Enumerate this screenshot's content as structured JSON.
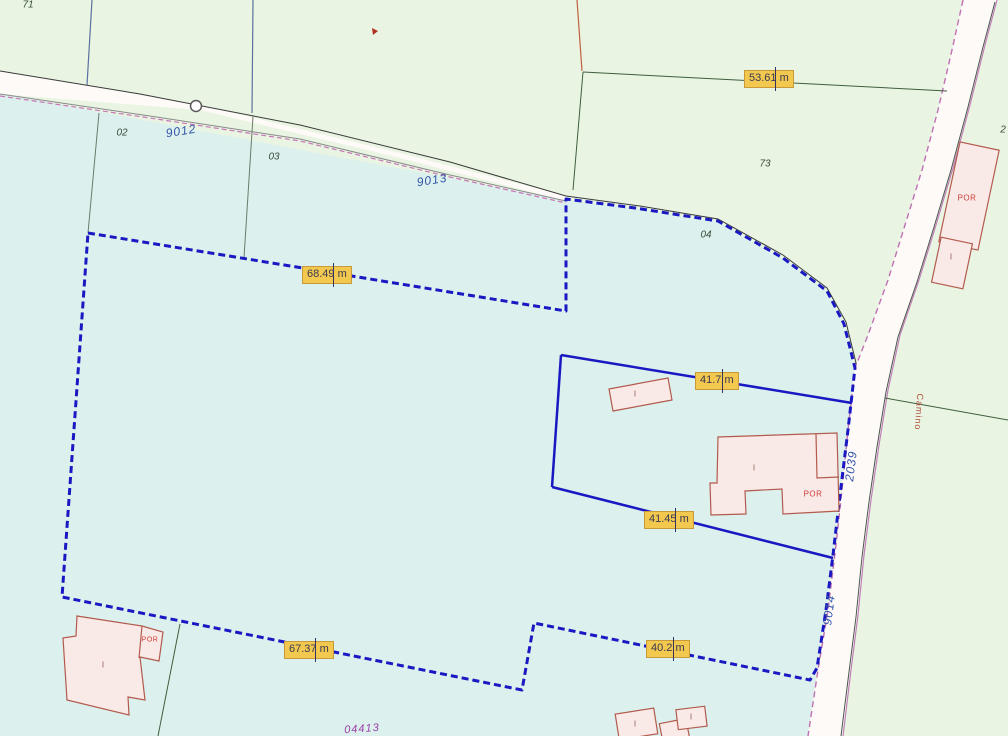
{
  "map": {
    "colors": {
      "background_green": "#E9F5E2",
      "selected_parcel_fill": "#DCF1ED",
      "road_fill": "#FDFAF8",
      "boundary_blue": "#1A18C2",
      "road_edge_pink": "#C070B4",
      "measure_label_bg": "#F2C84F",
      "measure_label_border": "#C89A3A",
      "building_fill": "#FAEAE7",
      "building_border": "#B25A4E"
    },
    "measurement_labels": [
      {
        "text": "53.61 m"
      },
      {
        "text": "52.91 m"
      },
      {
        "text": "46.83 m"
      },
      {
        "text": "68.49 m"
      },
      {
        "text": "41.7 m"
      },
      {
        "text": "52.01 m"
      },
      {
        "text": "20.19 m"
      },
      {
        "text": "41.45 m"
      },
      {
        "text": "17.02 m"
      },
      {
        "text": "67.37 m"
      },
      {
        "text": "9.64 m"
      },
      {
        "text": "40.2 m"
      }
    ],
    "road_labels": {
      "road_9012": "9012",
      "road_9013": "9013",
      "road_9014": "9014",
      "road_2039": "2039",
      "camino": "Camino",
      "parcel_04413": "04413"
    },
    "parcel_numbers": {
      "p71": "71",
      "p02": "02",
      "p03": "03",
      "p73": "73",
      "p04": "04",
      "p2_partial": "2"
    },
    "building_labels": {
      "por": "POR",
      "interior": "I"
    }
  }
}
